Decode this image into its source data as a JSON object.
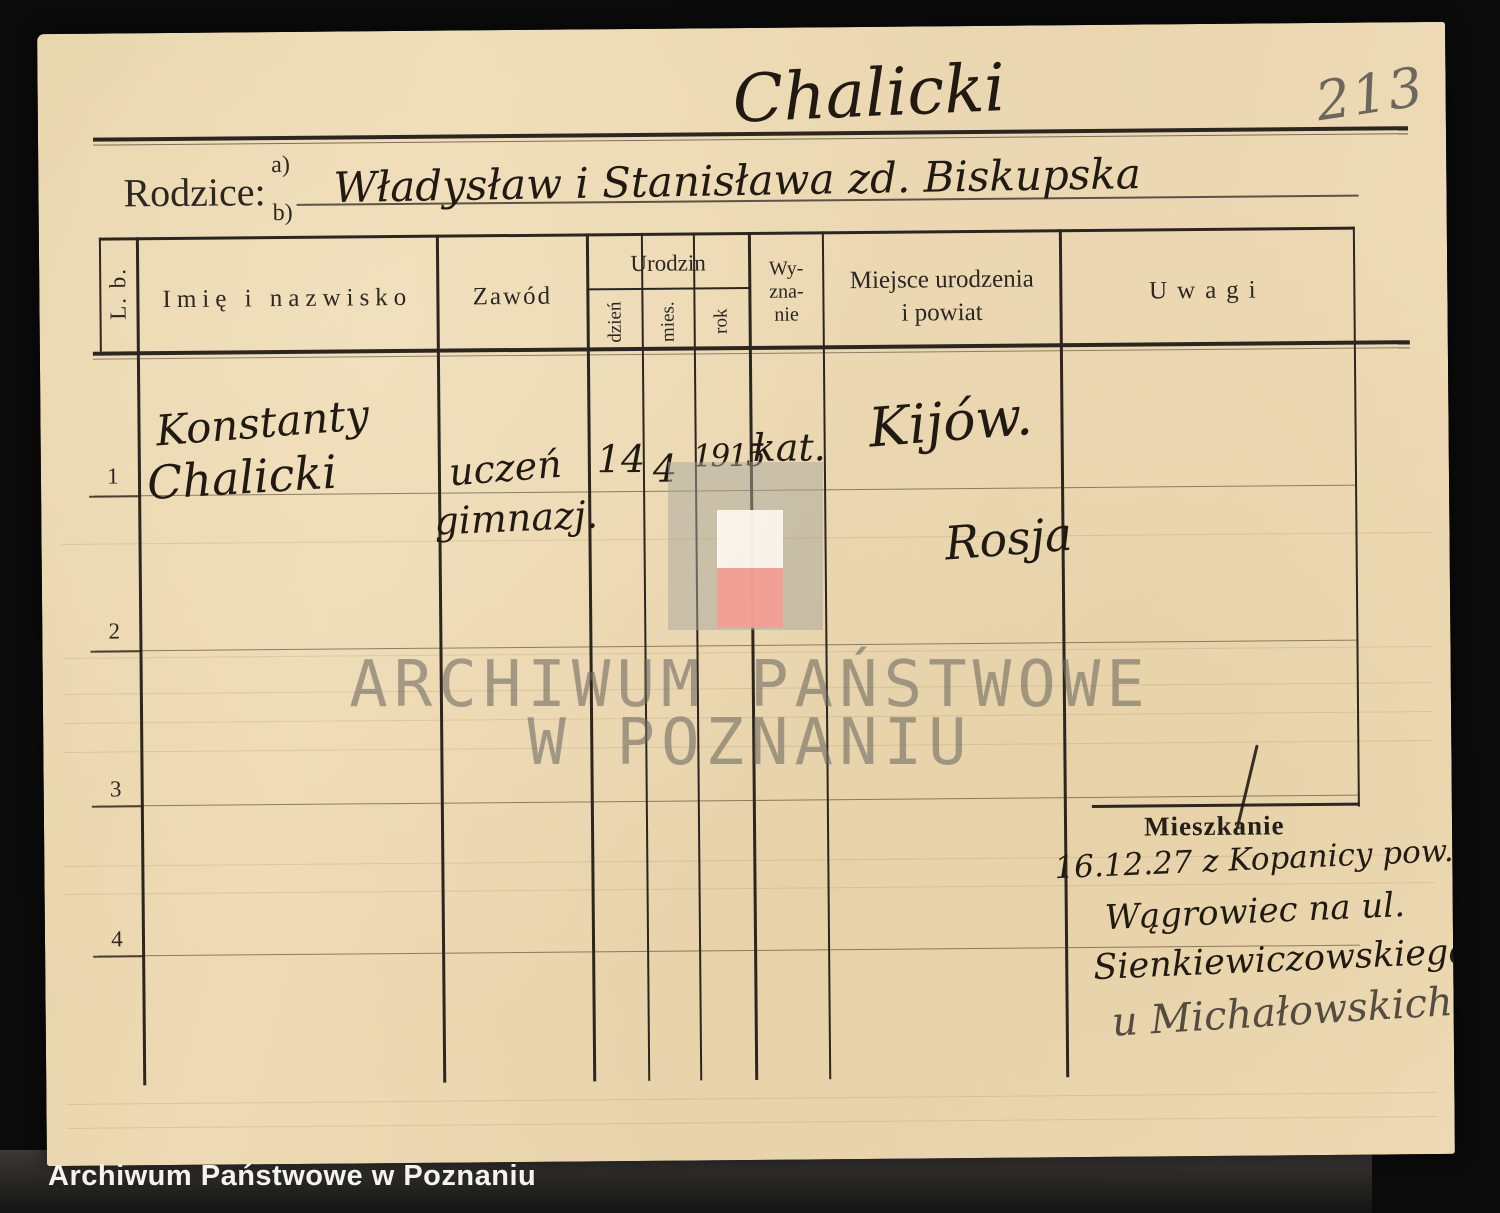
{
  "page_number": "213",
  "title_script": "Chalicki",
  "parents": {
    "label": "Rodzice:",
    "a_label": "a)",
    "b_label": "b)",
    "value_a": "Władysław i Stanisława zd. Biskupska"
  },
  "table": {
    "headers": {
      "lb": "L. b.",
      "name": "Imię i nazwisko",
      "profession": "Zawód",
      "birth_group": "Urodzin",
      "birth_day": "dzień",
      "birth_month": "mies.",
      "birth_year": "rok",
      "religion_lines": [
        "Wy-",
        "zna-",
        "nie"
      ],
      "birthplace_lines": [
        "Miejsce urodzenia",
        "i powiat"
      ],
      "remarks": "Uwagi"
    },
    "rows": [
      {
        "no": "1",
        "name_line1": "Konstanty",
        "name_line2": "Chalicki",
        "profession_line1": "uczeń",
        "profession_line2": "gimnazj.",
        "birth_day": "14",
        "birth_month": "4",
        "birth_year": "1915",
        "religion": "kat.",
        "birthplace_line1": "Kijów.",
        "birthplace_line2": "Rosja"
      },
      {
        "no": "2"
      },
      {
        "no": "3"
      },
      {
        "no": "4"
      }
    ]
  },
  "remarks_section": {
    "heading": "Mieszkanie",
    "note_lines": [
      "16.12.27 z Kopanicy pow.",
      "Wągrowiec na ul.",
      "Sienkiewiczowskiego 2",
      "u Michałowskich"
    ]
  },
  "watermark": {
    "line1": "ARCHIWUM PAŃSTWOWE",
    "line2": "W POZNANIU",
    "logo_outer_color": "#a8a69b",
    "logo_top_color": "#faf6ee",
    "logo_bottom_color": "#f2a096"
  },
  "caption": "Archiwum Państwowe w Poznaniu",
  "colors": {
    "background": "#0b0b0b",
    "paper": "#ebd8b1",
    "ink": "#201a12",
    "print": "#2c2721",
    "pencil": "#6c675d"
  }
}
